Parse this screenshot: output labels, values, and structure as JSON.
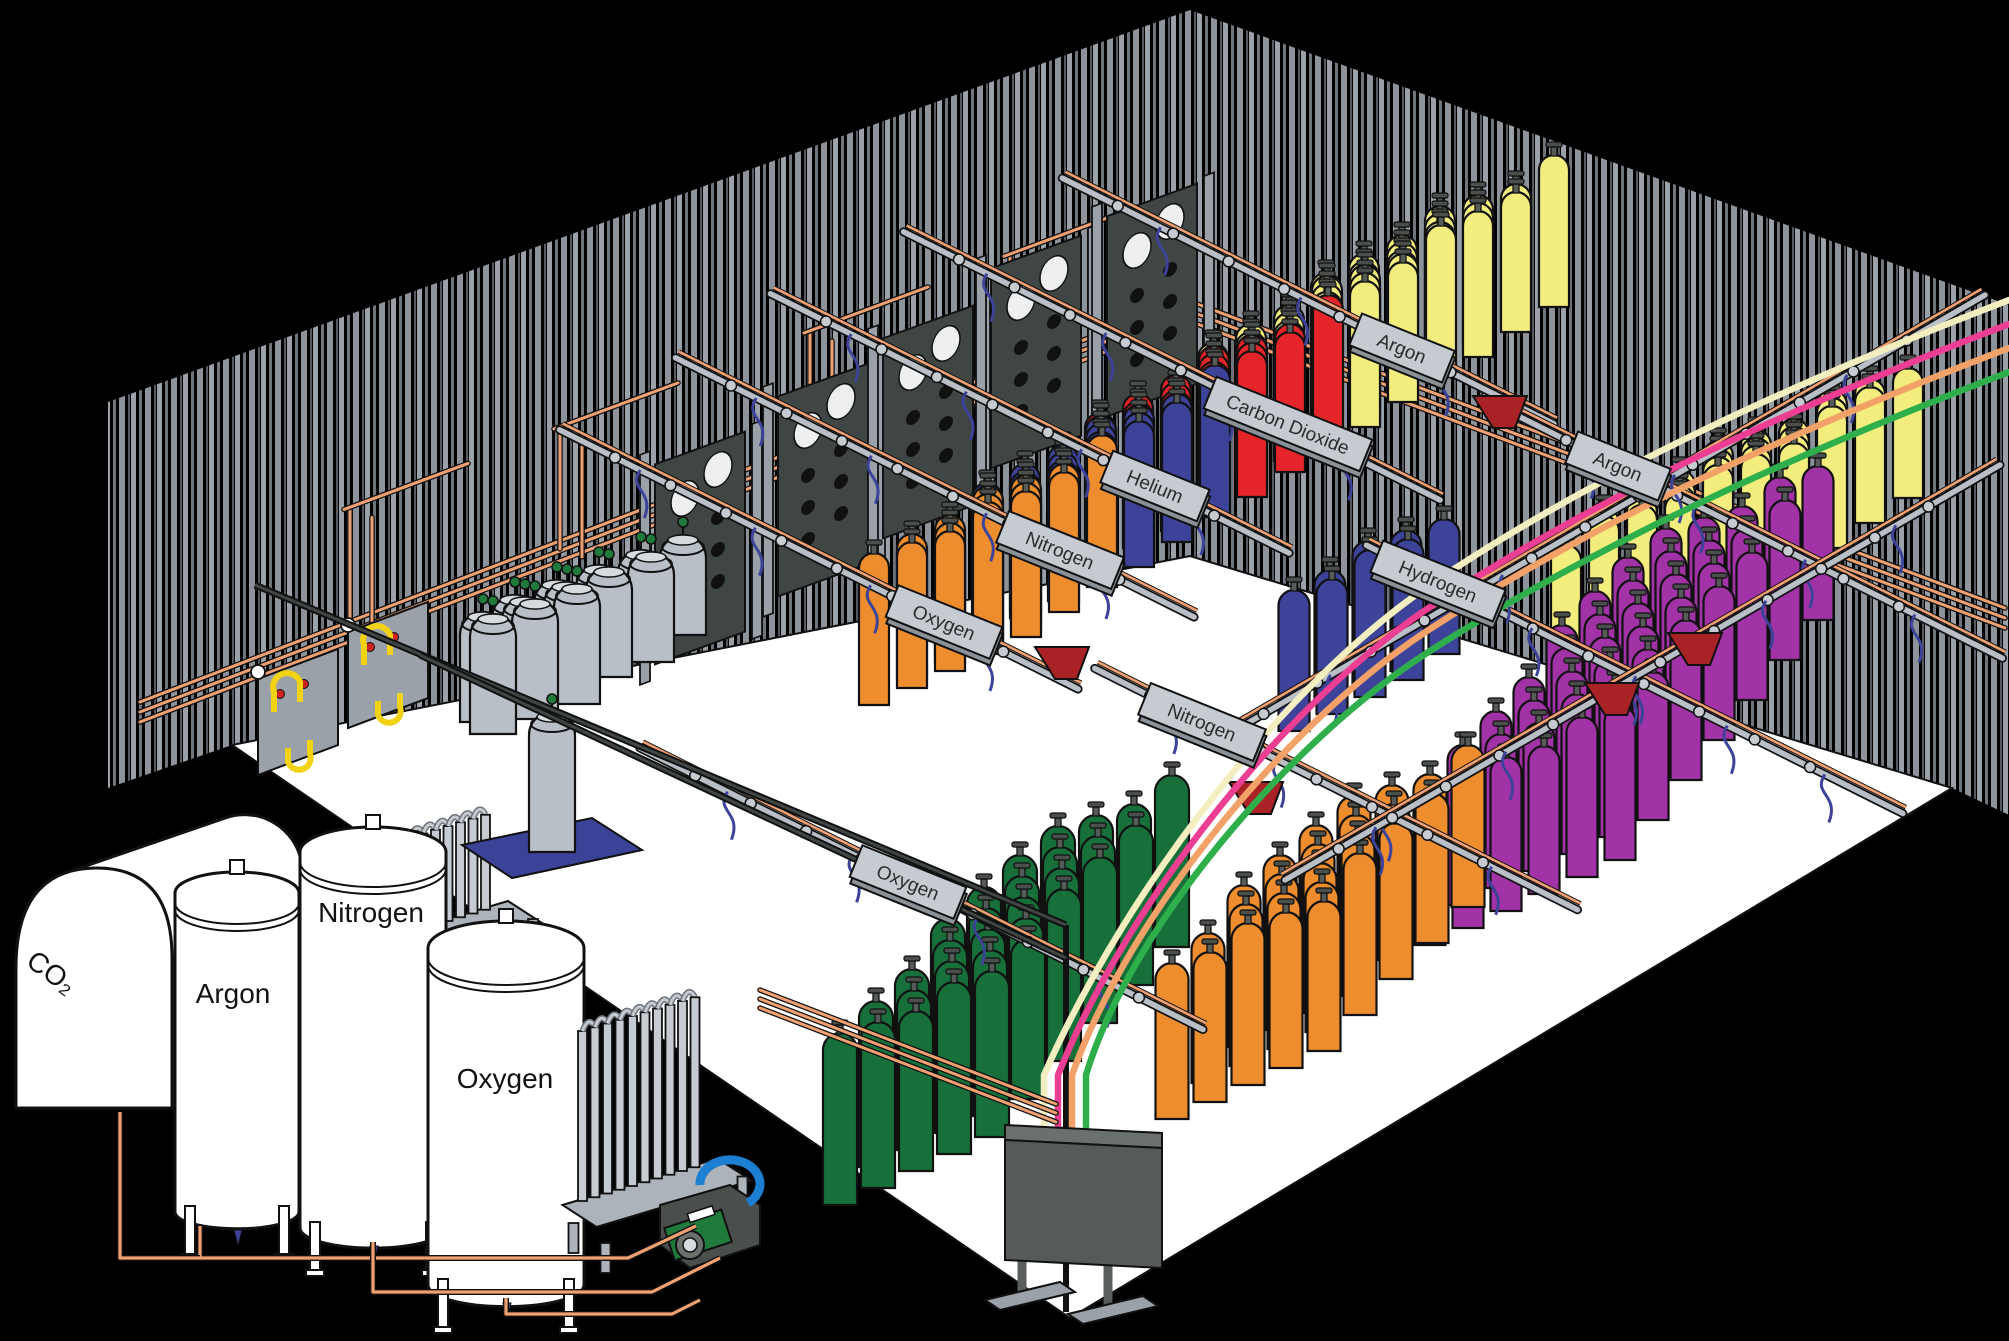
{
  "diagram": {
    "bulk_storage_tanks": [
      {
        "id": "co2-tank",
        "label": "CO₂"
      },
      {
        "id": "argon-tank",
        "label": "Argon"
      },
      {
        "id": "nitrogen-tank",
        "label": "Nitrogen"
      },
      {
        "id": "oxygen-tank",
        "label": "Oxygen"
      }
    ],
    "fill_row_signs": [
      {
        "id": "oxygen-back",
        "label": "Oxygen",
        "cylinder_color": "#EE8D2D"
      },
      {
        "id": "nitrogen-back",
        "label": "Nitrogen",
        "cylinder_color": "#3C4399"
      },
      {
        "id": "helium",
        "label": "Helium",
        "cylinder_color": "#E52529"
      },
      {
        "id": "carbon-dioxide",
        "label": "Carbon Dioxide",
        "cylinder_color": "#F2ED7D"
      },
      {
        "id": "argon-back",
        "label": "Argon",
        "cylinder_color": "#F2ED7D"
      },
      {
        "id": "argon-right",
        "label": "Argon",
        "cylinder_color": "#F2ED7D"
      },
      {
        "id": "hydrogen",
        "label": "Hydrogen",
        "cylinder_color": "#A233A7"
      },
      {
        "id": "nitrogen-front",
        "label": "Nitrogen",
        "cylinder_color": "#3C4399"
      },
      {
        "id": "oxygen-front",
        "label": "Oxygen",
        "cylinder_color": "#17703A"
      }
    ],
    "colors": {
      "background": "#000000",
      "floor": "#FFFFFF",
      "wall_stripe_light": "#9AA1A8",
      "wall_stripe_mid": "#8C939A",
      "wall_stripe_dark": "#6E757C",
      "outline": "#111111",
      "steel_light": "#C6CBD2",
      "steel_mid": "#9AA1A8",
      "panel_face": "#3F4643",
      "copper": "#F0A172",
      "hose_blue": "#3C4399",
      "flex_cream": "#F3EEC0",
      "flex_pink": "#EC3E92",
      "flex_orange": "#F2A268",
      "flex_green": "#2FAE4C",
      "header_red": "#A92225",
      "dewar_gray": "#B9BFC7",
      "platform_blue": "#3A4398",
      "pump_green": "#1F7A3C",
      "pump_blue": "#1C7FD1",
      "tank_white": "#FFFFFF",
      "sign_plate": "#C6CBD2",
      "sign_text": "#2B2B2B"
    }
  }
}
